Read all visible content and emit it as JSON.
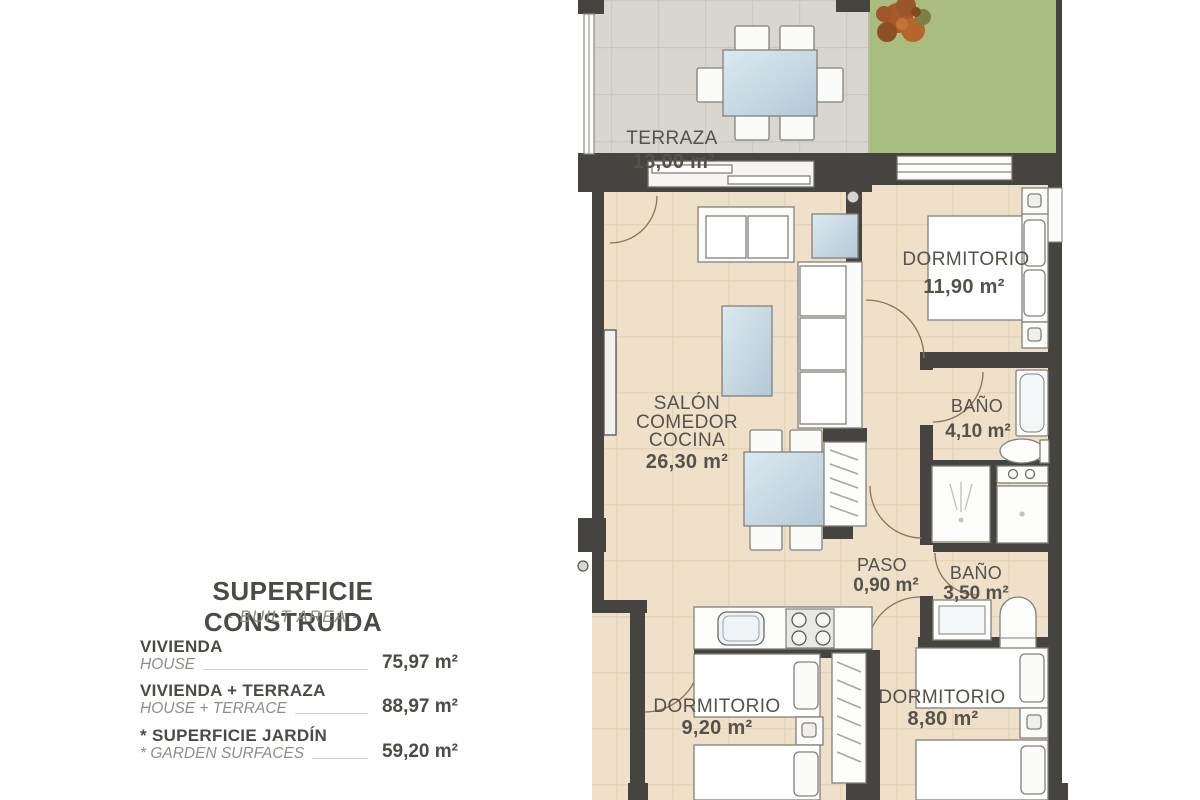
{
  "legend": {
    "title": "SUPERFICIE CONSTRUIDA",
    "subtitle": "- BUILT AREA -",
    "rows": [
      {
        "es": "VIVIENDA",
        "en": "HOUSE",
        "value": "75,97 m²"
      },
      {
        "es": "VIVIENDA + TERRAZA",
        "en": "HOUSE + TERRACE",
        "value": "88,97 m²"
      },
      {
        "es": "* SUPERFICIE JARDÍN",
        "en": "* GARDEN SURFACES",
        "value": "59,20 m²"
      }
    ]
  },
  "rooms": {
    "terraza": {
      "name": "TERRAZA",
      "area": "13,00 m²"
    },
    "dormitorio_principal": {
      "name": "DORMITORIO",
      "area": "11,90 m²"
    },
    "bano_1": {
      "name": "BAÑO",
      "area": "4,10 m²"
    },
    "salon": {
      "name1": "SALÓN",
      "name2": "COMEDOR",
      "name3": "COCINA",
      "area": "26,30 m²"
    },
    "paso": {
      "name": "PASO",
      "area": "0,90 m²"
    },
    "bano_2": {
      "name": "BAÑO",
      "area": "3,50 m²"
    },
    "dormitorio_2": {
      "name": "DORMITORIO",
      "area": "9,20 m²"
    },
    "dormitorio_3": {
      "name": "DORMITORIO",
      "area": "8,80 m²"
    }
  },
  "colors": {
    "wall": "#454440",
    "terrace_floor": "#d9d6d2",
    "garden": "#a8bd7e",
    "interior_floor": "#efe0c9",
    "glass": "#c9dce8",
    "label_text": "#55524c"
  }
}
